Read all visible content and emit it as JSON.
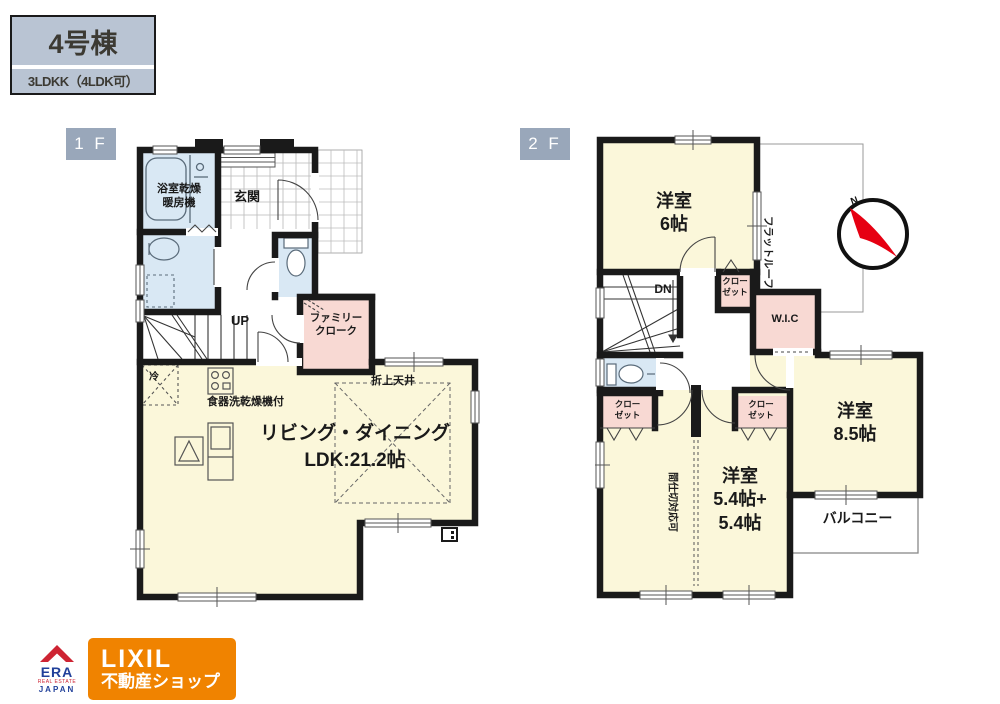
{
  "header": {
    "title": "4号棟",
    "subtitle": "3LDKK（4LDK可）"
  },
  "floor1": {
    "label": "1 F",
    "labels": {
      "bathroom1": "浴室乾燥",
      "bathroom2": "暖房機",
      "entrance": "玄関",
      "up": "UP",
      "cloak1": "ファミリー",
      "cloak2": "クローク",
      "fridge": "冷",
      "dishwasher": "食器洗乾燥機付",
      "ceiling": "折上天井",
      "ldk1": "リビング・ダイニング",
      "ldk2": "LDK:21.2帖"
    }
  },
  "floor2": {
    "label": "2 F",
    "labels": {
      "bed6_1": "洋室",
      "bed6_2": "6帖",
      "flatroof": "フラットルーフ",
      "dn": "DN",
      "closet_a1": "クロー",
      "closet_a2": "ゼット",
      "wic": "W.I.C",
      "closet_b1": "クロー",
      "closet_b2": "ゼット",
      "closet_c1": "クロー",
      "closet_c2": "ゼット",
      "bed54_1": "洋室",
      "bed54_2": "5.4帖+",
      "bed54_3": "5.4帖",
      "partition": "間仕切対応可",
      "bed85_1": "洋室",
      "bed85_2": "8.5帖",
      "balcony": "バルコニー"
    }
  },
  "compass": {
    "north": "N"
  },
  "logo": {
    "era": "ERA",
    "era_tagline": "REAL ESTATE",
    "era_country": "JAPAN",
    "brand": "LIXIL",
    "brand_service": "不動産ショップ"
  },
  "colors": {
    "wall": "#1a1a1a",
    "room_yellow": "#fbf7da",
    "wet_blue": "#d9e8f4",
    "closet_pink": "#f8d9d3",
    "header_bg": "#b9c4d3",
    "floor_tag_bg": "#99a7ba",
    "brand_orange": "#f08300",
    "era_red": "#ce2433",
    "era_blue": "#21409a",
    "compass_red": "#e60012"
  }
}
